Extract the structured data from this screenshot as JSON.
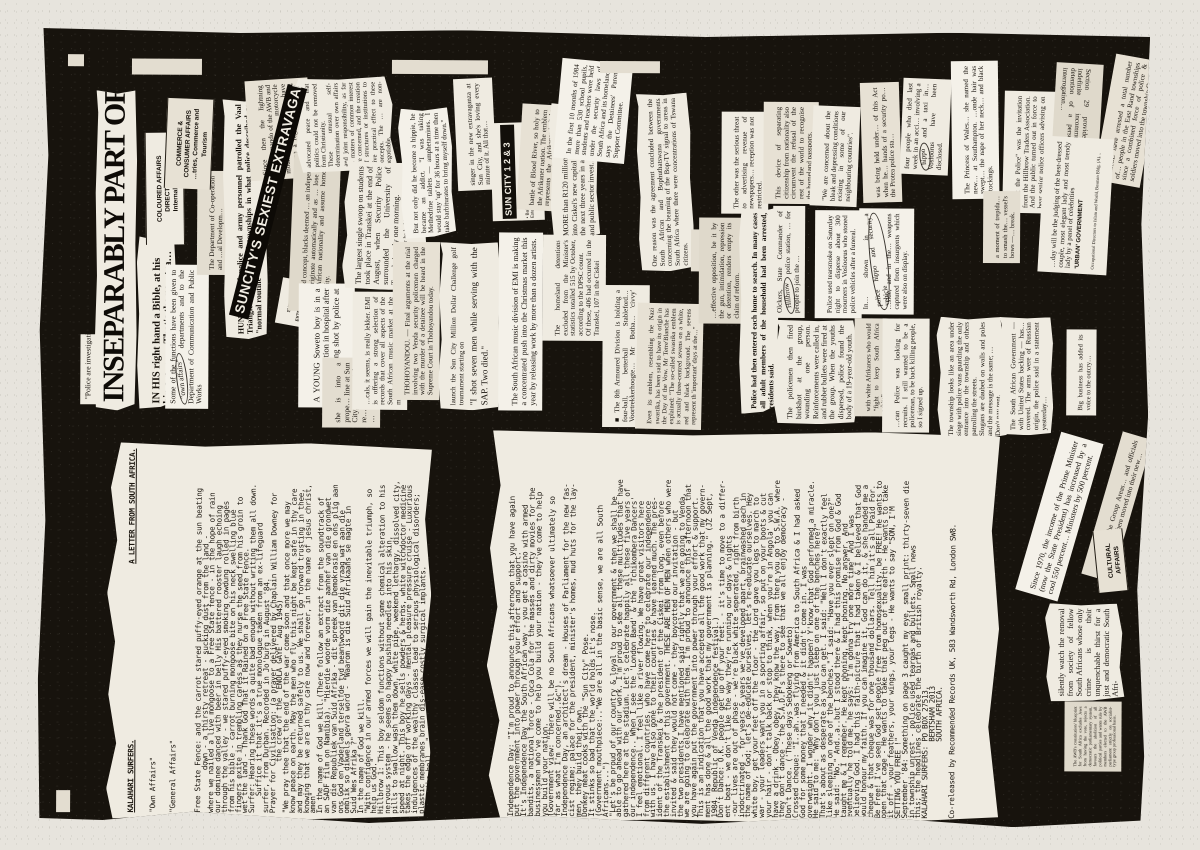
{
  "artwork": {
    "headline": "INSEPARABLY PART OF YOUR LIFE",
    "kicker": "\"Police are investigating.\"",
    "accent_paper": "#e7e4dd",
    "accent_ink": "#17130d"
  },
  "letter": {
    "header_left": "KALAHARI SURFERS.",
    "header_right": "A LETTER FROM SOUTH AFRICA.",
    "sub1": "\"Own Affairs\"",
    "sub2": "\"General Affairs\"",
    "body1": "Free State Fence: and the carrot stared puffy-eyed orange at the sun beating\n          down - a thirsty retreat - sucking dust from the land -\nwhere we nailed a live mongoose to a Free State fence - in the hope of rain\nour dominee danced with beer in belly His battered rooster laugh echoing\nthrough the valley - we stared puffy-eyed smoking cowdung rolled in pages\nfrom his bible - carrot burning mongoose bite on his neck swelling blue\nfingers exite in trembling caress as they nurse the seed from his groin to\nwet the land - Thank God That it Rained on a Free State Fence.\nSurfer: Hearing these words a quite bad enough without writing them all down.\n    Suffice it that it's a true monologue taken from an ex-lifeguard\nsurfer, from Durban. Recorded in Jo'burg in August '84.\nPrayer for Civilisation: (a prayer delivered by Chaplain William Downey for\n            the crew of the 'ENOLA GAYE' Aug 1945)\n\"We pray thee that the end of the war come soon and that once more we may\nknow peace on earth. May the men who fly this night be kept safe in thy care\nand may they be returned safely to us. We shall go forward trusting in thee,\nknowing that we are in thy care now and forever, in the name of jesus christ,\namen\"\nIn the name of God we kill.(There follow an extract from the soundtrack of\nan SADF film on Namibia). \"Hierdie woorde vorm die aanhef van die grondwet\nvan die Republiek van Suid Afrika - dit spreek van Demokrasie en ons plig aan\nons God en Vaderland terselfde tyd beantwoord dit die vraag wat aan die\nomblik so dikwels gevra word - \"Waarom is die Suid Afrikaans se magte in\nSuid Wes Afrika ?\"\nIn the name of God we kill.\n\"With confidence in our armed forces we will gain the inevitable triumph, so\nhelp us God.\"\nHillbrow 1: This boy seldom functions without some chemical alteration to his\nnervous system - he seems so happy pushing needles into his skin,\npills to swallow wash them down, white pipe, weekend lethargy, dissolved city,\nspeed at night. This boy he sells powders & herbs, white witchdoctor medicine\ntakes the edge off working days - mental pleasure pressure cruise - Luxurious\nindulgences of the wealthy classes lead to serious physiological disorders;\nplastic membranes brain dis-ease costly surgical implants.\n\"What the hell...\"\n\"Hold it right there Le Roux\"\n\"but..a..you never can be too sure.\"\n\"Ya I know what you mean.\"\n\"...ah...it's pitch dark in here.\"\n\"Living with crime and violence.\"\n\"Protect the people of South Africa.\"\nHillbrow II: Hands move across things to get at the telephone.",
    "body2": "Independence Day: \"I'm proud to announce this afternoon that you have again\nput the government into power through your effort and support.\"\nIt's Independence Day the South African way - you get a casino with armed\nbandits, a national force - Coca Cola for the masses and dirty movies for the\nbusinessmen who've come to help you build your nation - they've come to help\nyou build your nation.\n(Government view: \"there will be no South Africans whatsoever ultimately so\nfar as what I'm concerned..&c\").\nIndependence Day, an architect's dream - Houses of Parliament for the new fas-\ncist regime; palace for the president, minister's homes, mud huts for the lay-\nmen, they build their own.\nDonkey meat cooks with the \"Sun City\" Pose.\nIt stinks so bad that the world holds it's nose.\n(Government mouthpiece:..\"We are all in the basic sense, we are all South\nAfricans...\")\n\"Let's be proud of our country & loyal to our government & then we shall be\nable to go ahead with our work. I'm proud to see all these multitudes that have\ngathered here at the stadium. Let's celebrate happily all these five years of\nour independence.. When I see the 'London Band' & the 'Tchikombera Dancers'\nI feel emotional. I feel like a river flowing. We have great visitors here\nfrom different countries, who have come here to celebrate our independence\nwith us. I have also gone to their countries & have learned much. The pres-\nident of the Transkei & the president of the Ciskei from long, even before\nthe establishment of this government. THESE ARE MEN OF MEN when others who were\ninvited & said they would not come - they boycotted our invitation - but\nthe two presidents I have mentioned said rightly that we are going to Venda,\nwe are going to celebrate with them. I'm proud to announce this afternoon that\nyou have again put the government into power through your effort & support.\nThis is an indication that you have accepted all the good work that my govern-\nment has done & all the good work that my government is planning.\" (JZ Sept,\n1984. Republic of Venda independence festival.)\nDon't Dance: O.K. people get up off your feet. - it's time to move to a differ-\nent beat - we don't like the way they're running our days & nights\n-our lives are out of phase - we're black white seperated, right from birth\nindoctrinated - for years & years we've developed apart, brainwashed each in\nthe name of God; let's de-educate ourselves, let's re-educate ourselves. Hey\nwhite boy, get your feet off the floor - the Lord gave you legs to march to\nwar - your leaders want you in a sporting affair, so put on your boots & cut\nyour hair - don't talk back or stop to think, when you're in Angola' you can\nhave a drink - Obey, obey, they know the way, from there you go to S.W.A. where\nthey don't dance - the S.A.D.F's there to see that we all enjoy democracy -\nDon't Dance. ('These days Sebokeng or Soweto)\nCrossed cheque: \"I..ah..was flying from America to South Africa & I had asked\nGod for some money that I needed & it didn't come in. I was\noverweight. I wonder why it didn't happen? Y'know that God performed a miracle.\nHe said to me: \"Why don't you just sleep on one of the benches here?\"\nThat's about as desperate as you can get. I said: \"Well I don't exactly feel\nlike sleeping on one of the benches.\" I said: \"Have you ever slept on one?\"\nHe said: \"No.\" And..a..but I stood there & I had this promise from God & God\ntaught me & I remember. He kept phoning, kept phoning. No answer. And\neventually he told me, he says: \"I'm gonna try one more time\" And I was\nbelieving God. I had this faith-picture that I had taken & I believed that God\nwould honour my faith. If you can imagine it, God can do it, & she handed me a\ncheque & that cheque was for one thousand dollars. Tell him it's all Paid For.\nBe Free! I've seen God set people free from homosexuality. be FREE! He wants to\nopen that cage - He wants to take that peg out of the earth - He wants to take\nit off - your feathers, your wings, your legs - He wants to say \"SON, I'M\nSETTING YOU FREE !\"\nSeptember '84: Something on page 3 caught my eye, small print: thirty-seven die\nin township unrest - police used teargas and bullets. Small news\nthis; the headlines celebrate the birth of British royalty.\nKALAHARI SURFERS: PO BOX 27513,\n                  BERTSHAM 2013\n                  SOUTH AFRICA.\n\nCo-released by Recommended Records UK, 583 Wandsworth Rd, London SW8."
  },
  "clips": {
    "in_his": {
      "text": "IN HIS right hand a Bible, at his hip a gun . . . That's the new tra…"
    },
    "some_functions": {
      "pre": "Some of the functions have been given to ",
      "circled": "\"own affairs\"",
      "post": " departments and to the Department of Communication and Public Works"
    },
    "dept_co": {
      "text": "The Department of Co-operation and …al Developm…"
    },
    "coloured_affairs": {
      "text": "COLOURED AFFAIRS DIRECTORATE\nInternal Affairs"
    },
    "commerce_affairs": {
      "text": "COMMERCE & CONSUMER AFFAIRS\n…tries, Commerce and Tourism"
    },
    "hundreds": {
      "text": "HUNDREDS of police and army personnel patrolled the Vaal Triangle and East Rand townships in what police described as \"normal routine\" duties."
    },
    "awb_stormvalke": {
      "text": "Since then the lightning Blitkommando of the AWB and blackshirted, motorcycle mounted Stormvalke have become a regular sight at its meetings."
    },
    "suncity_bar": {
      "text": "SUNCITY'S SEXIEST EXTRAVAGANZA EVER"
    },
    "suncity_hotel": {
      "text": "SUN CITY HOTEL\nEXTRAVAGANZA"
    },
    "apartheid_concept": {
      "text": "apartheid concept, blacks deemed … an independent … to originate automatically and as … lose their South African nationality and assume homeland nationality."
    },
    "advocated_peace": {
      "text": "advocated peace and that politics could not be removed from Christianity.\nThese unusual self-determination over own affairs and joint responsibility, as far as matters of common interest are concerned, and the creation of structures or institutions to give practical effect to these concepts. The … are non-negotiable."
    },
    "young_soweto": {
      "text": "A YOUNG Soweto boy is in a serious condition in hospital after allegedly being shot by police at the weekend."
    },
    "she_is_into": {
      "text": "she is into a prope… line at Sun City,… every night, re… mealtimes and …"
    },
    "largest_swoop": {
      "text": "The largest single swoop on students took place in Transkei at the end of August, when Security Police surrounded the University of Transkei early one morning.",
      "sub": "was shot dead after he had broken into a vegetable shop."
    },
    "emi_lekker": {
      "text": "…cals, it seems, is really lekker. EMI is offering a strong selection of records that cover all aspects of the South African music market at the moment."
    },
    "thohoyandou": {
      "text": "THOHOYANDOU. — Final arguments at the trial involving two Venda security policemen charged with the murder of a detainee will be heard in the Supreme Court in Thohoyandou today."
    },
    "hippie": {
      "text": "But not only did he become a hippie, he became an addict. \"I was taking Methedrine tablets — amphetamines. I would stay 'up' for 36 hours at a time then take barbiturates to bring myself down.\""
    },
    "singer": {
      "text": "singer in the new extravaganza at Sun City, and she's loving every minute of it. All that…"
    },
    "suncity123": {
      "bar": "SUN CITY 1 2 & 3",
      "tracks": "• Baby Love • Body Magic • Frank… • Exterminator • Playgirl"
    },
    "shot_seven": {
      "text": "launch the Sun City Million Dollar Challenge golf tournament starting on",
      "quote": "\"I shot seven men while serving with the SAP. Two died.\""
    },
    "emi_xmas": {
      "text": "The South African music division of EMI is making a concentrated push into the Christmas market this year by releasing work by more than a dozen artists."
    },
    "blood_river": {
      "text": "battle of Blood River, so holy to the Afrikaner nation. The emblem represents the Afrikaners' fight for freedom…"
    },
    "detentions": {
      "text": "The homeland detentions excluded from the Minister's statistics totalled 515 by October, according to the DPSC count.\nOf these, 406 had occurred in the Transkei, 107 in the Ciskei"
    },
    "r120": {
      "text": "MORE than R120 million is to be pumped into Ciskei's new capital city, Bisho, over the next three years in a series of private and public sector invest…"
    },
    "first10": {
      "text": "In the first 10 months of 1984 more than 530 school pupils, students and teachers were held under the security laws of South Africa and its homelands, says the Detainees' Parents Support Committee."
    },
    "armoured": {
      "text": "■ The 8th Armoured Division is holding a four-ball, betterball Stableford… Voortrekkerhoogte… Mr Botha… 'civvy' golfers to…"
    },
    "swastika": {
      "text": "Even its emblem, resembling the Nazi swastika, has been said to have its origin in the Day of the Vow. Mr Terre'Blanche has explained: \"The so-called swastika emblem is actually three-centred sevens on a white, red and black background. The sevens represent th 'important' days at the…\""
    },
    "boptv": {
      "text": "One reason was the agreement concluded between the South African and Bophuthatswana governments concerning the beaming of the Bop-TV signal to areas in South Africa where there were concentrations of Tswana citizens."
    },
    "sure_drugs": {
      "text": "…sure if drugs"
    },
    "threat_adv": {
      "text": "The other was the serious threat to advertising revenue of newspapers… reception was not restricted."
    },
    "renders_empty": {
      "text": "…effective opposition, be it by the gun, intimidation, repression or detention, renders empty its claim of reform."
    },
    "entered_homes": {
      "text": "Police had then entered each home to search. In many cases all adult members of the household had been arrested, residents said."
    },
    "olckers": {
      "pre": "Olckers, State Commander of ",
      "circled": "Hillbrow",
      "post": " police station, … for people to join the …"
    },
    "tearsmoke": {
      "text": "Police used tearsmoke on Saturday night to disperse about 300 mourners in Vosloorus who stoned police vehicles after a funeral."
    },
    "separating": {
      "text": "This device of separating citizenship from nationality also circumvent the refusal of the rest of the world to recognise the homeland passports."
    },
    "concerned": {
      "text": "\"We are concerned about the bleak and depressing conditions existing in some of our neighbouring countries\"."
    },
    "birdshot": {
      "text": "The policemen then fired birdshot at the group, wounding one person. Reinforcements were called in, and rubber bullets were fired at the group. When the youths dispersed, police found the body of a 19-year-old youth."
    },
    "afrikaners_white": {
      "text": "with white Afrikaners who would \"fight to keep South Africa white\"."
    },
    "recruits": {
      "text": "…can Police was looking for recruits. I still wanted to be a policeman, to be back killing people, so I signed up."
    },
    "weapons": {
      "pre": "In… shown in a ",
      "circled": "police hippo and security vehicle",
      "post": " …side, and in the… weapons captured from insurgents which were also on display."
    },
    "protea": {
      "text": "was being held under… of this Act when he… hands of a security po… the Protea police sta…"
    },
    "hippo_taxi": {
      "pre": "four people who died last week in an acci… involving a ",
      "circled": "hippo",
      "post": " and a taxi in… Vosloorus have been disclosed."
    },
    "township_siege": {
      "text": "The township looks like an area under siege with police vans guarding the only entrance into the township and others patrolling the streets.\nSlogans are daubed on walls and poles and the message is the same; …\nDon't pay rent."
    },
    "princess": {
      "text": "The Princess of Wales… she named the new… at Southampton. …onde hair was swept… the nape of her neck… and black stockings."
    },
    "meet_police": {
      "text": "\"Meet the Police\" was the invitation from the Hillbrow Traders Association. And the public turned out in force to hear senior police officers advising on securi…"
    },
    "trepidation": {
      "text": "a moment of trepida… to smash the… vessel's bows —… break."
    },
    "russian_arms": {
      "text": "The South African Government — with United States backing — has… covered. The arms were of Russian origin, the police said in a statement yesterday…"
    },
    "section29": {
      "text": "Section 29 provides for indefinite incommunicado detention of a person for interrogation…"
    },
    "east_rand": {
      "text": "…LICE have arrested a total number of… people in the East Rand townships since a combined force of police & soldiers moved into the township Octo…"
    },
    "best_dressed": {
      "text": "…day will be the judging of the best-dressed couple, most elegant lady and most trendy lady by a panel of celebrities",
      "sub1": "'URBAN' GOVERNMENT",
      "sub2": "Occupational Directors to Islam and World, Bosman Bldg. (A)…"
    },
    "since1970": {
      "text": "Since 1970, the income of the Prime Minister (now the State President) has increased by a cool 550 percent… Ministers by 500 percent."
    },
    "group_areas": {
      "text": "…taken over the Group Areas… and officials involved in… sphere moved into their new…"
    },
    "big_business": {
      "text": "Big business has added its voice to the outcry…"
    },
    "cultural_affairs": {
      "text": "CULTURAL AFFAIRS"
    },
    "silently": {
      "text": "silently watch the removal from society of fellow South Africans whose only crime is their unquenchable thirst for a just and democratic South Afri-"
    },
    "awb_constitution": {
      "text": "The AWB's constitution/ blueprint for South Africa excludes Jews from having the vote, rejects a democratic parliamentary system, favours the abolition of all political parties and wants rule by members elected to the AWB parliament strictly on socialist-type group professional basis."
    }
  }
}
